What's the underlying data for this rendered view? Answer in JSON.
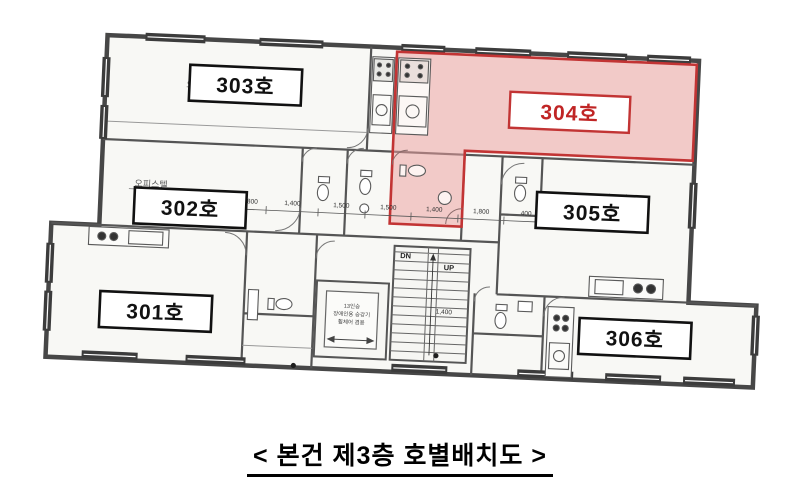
{
  "caption": "< 본건 제3층 호별배치도 >",
  "units": [
    {
      "id": "301",
      "label": "301호"
    },
    {
      "id": "302",
      "label": "302호"
    },
    {
      "id": "303",
      "label": "303호"
    },
    {
      "id": "304",
      "label": "304호",
      "highlighted": true
    },
    {
      "id": "305",
      "label": "305호"
    },
    {
      "id": "306",
      "label": "306호"
    }
  ],
  "annotations": {
    "officetel_left": "오피스텔",
    "officetel_right": "오피스텔",
    "officetel_partial": "오",
    "stairs_dn": "DN",
    "stairs_up": "UP",
    "elevator_line1": "13인승",
    "elevator_line2": "장애인용 승강기",
    "elevator_line3": "휠체어 겸용",
    "dim_core": "1,400",
    "dimensions": [
      "800",
      "1,400",
      "1,500",
      "1,500",
      "1,400",
      "1,800",
      "400"
    ]
  },
  "colors": {
    "highlight_fill": "#eba0a0",
    "highlight_stroke": "#c23434",
    "highlight_text": "#c02525",
    "wall": "#4a4a4a"
  }
}
